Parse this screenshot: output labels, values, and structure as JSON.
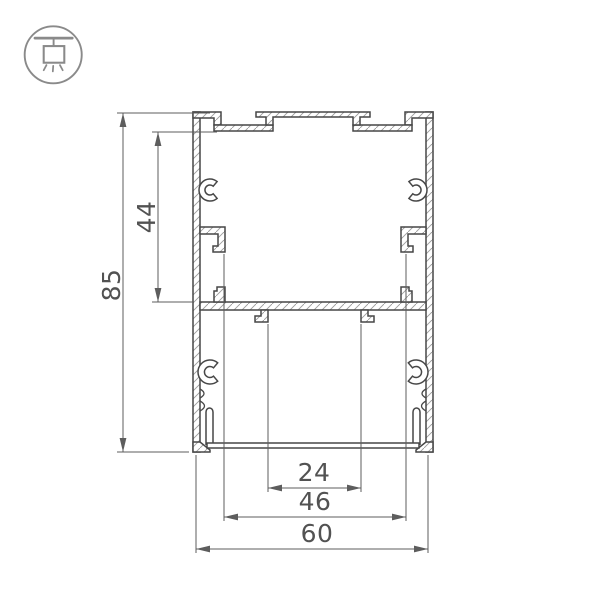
{
  "logo": {
    "icon": "pendant-light-icon"
  },
  "drawing": {
    "type": "aluminium-profile-cross-section",
    "dimensions": {
      "overall_height": "85",
      "channel_height": "44",
      "slot_width": "24",
      "inner_width": "46",
      "overall_width": "60"
    },
    "colors": {
      "outline": "#474747",
      "dimension_lines": "#5d5d5d",
      "hatch": "#9b9b9b",
      "logo": "#8a8a8a"
    }
  }
}
